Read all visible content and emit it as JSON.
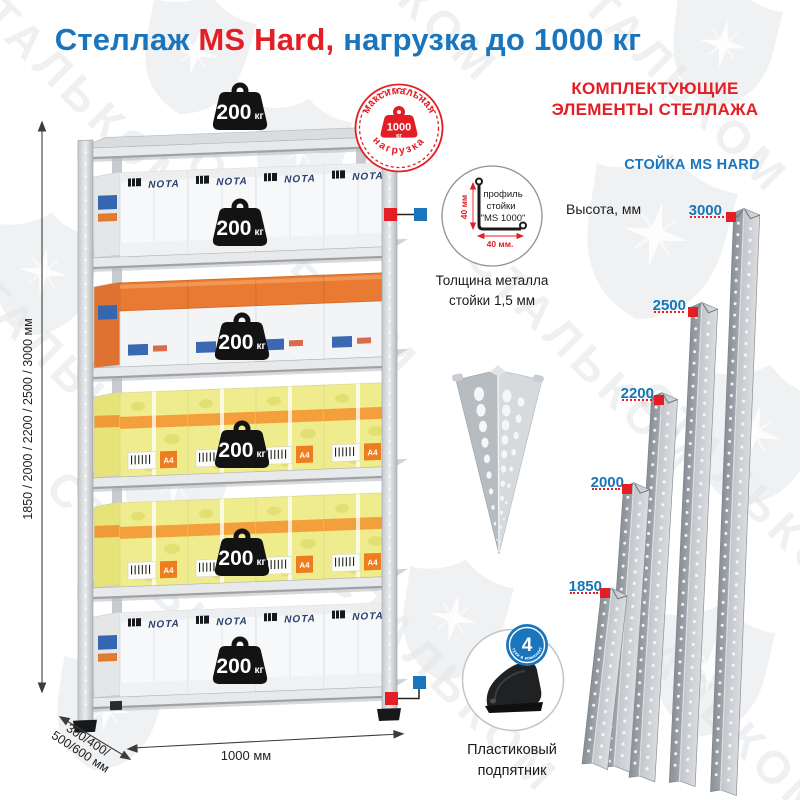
{
  "watermark": {
    "text": "СТАЛЬКОМ"
  },
  "title": {
    "part1": "Стеллаж ",
    "part2": "MS Hard,",
    "part3": " нагрузка до 1000 кг"
  },
  "colors": {
    "blue": "#1b75bc",
    "red": "#e31e24"
  },
  "rack": {
    "load": {
      "value": "200",
      "unit": "кг"
    },
    "max_load_badge": {
      "arc_top": "максимальная",
      "arc_bottom": "нагрузка",
      "value": "1000",
      "unit": "кг"
    },
    "dimensions": {
      "height": "1850 / 2000 / 2200 / 2500 / 3000 мм",
      "depth_line1": "300/400/",
      "depth_line2": "500/600 мм",
      "width": "1000 мм"
    },
    "box_brand": "NOTA",
    "box_label_a4": "A4"
  },
  "profile_callout": {
    "caption_line1": "профиль",
    "caption_line2": "стойки",
    "caption_line3": "\"MS 1000\"",
    "dim_vertical": "40 мм",
    "dim_horizontal": "40 мм.",
    "note_line1": "Толщина металла",
    "note_line2": "стойки 1,5 мм"
  },
  "foot_callout": {
    "badge_value": "4",
    "badge_arc": "штуки в комплекте",
    "label_line1": "Пластиковый",
    "label_line2": "подпятник"
  },
  "right_panel": {
    "header_line1": "КОМПЛЕКТУЮЩИЕ",
    "header_line2": "ЭЛЕМЕНТЫ СТЕЛЛАЖА",
    "subheader": "СТОЙКА MS HARD",
    "height_caption": "Высота, мм",
    "posts": [
      {
        "height": "3000"
      },
      {
        "height": "2500"
      },
      {
        "height": "2200"
      },
      {
        "height": "2000"
      },
      {
        "height": "1850"
      }
    ]
  }
}
